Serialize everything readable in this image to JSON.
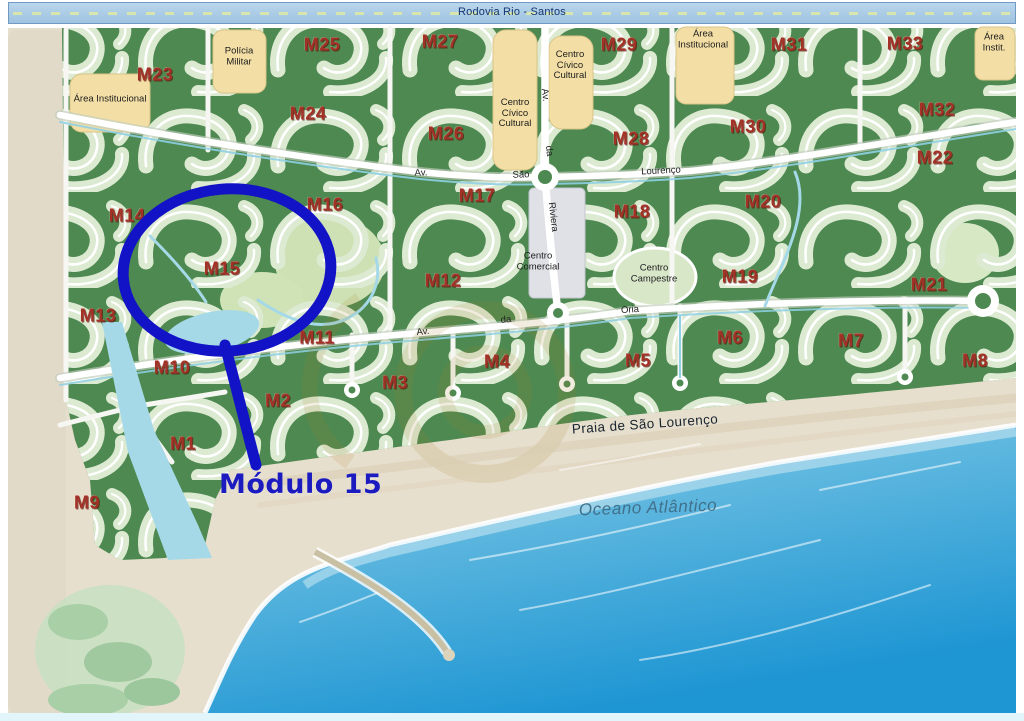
{
  "highway": {
    "label": "Rodovia Rio - Santos"
  },
  "modules": [
    {
      "id": "M1",
      "x": 183,
      "y": 444
    },
    {
      "id": "M2",
      "x": 278,
      "y": 401
    },
    {
      "id": "M3",
      "x": 395,
      "y": 383
    },
    {
      "id": "M4",
      "x": 497,
      "y": 362
    },
    {
      "id": "M5",
      "x": 638,
      "y": 361
    },
    {
      "id": "M6",
      "x": 730,
      "y": 338
    },
    {
      "id": "M7",
      "x": 851,
      "y": 341
    },
    {
      "id": "M8",
      "x": 975,
      "y": 361
    },
    {
      "id": "M9",
      "x": 87,
      "y": 503
    },
    {
      "id": "M10",
      "x": 172,
      "y": 368
    },
    {
      "id": "M11",
      "x": 317,
      "y": 338
    },
    {
      "id": "M12",
      "x": 443,
      "y": 281
    },
    {
      "id": "M13",
      "x": 98,
      "y": 316
    },
    {
      "id": "M14",
      "x": 127,
      "y": 216
    },
    {
      "id": "M15",
      "x": 222,
      "y": 269
    },
    {
      "id": "M16",
      "x": 325,
      "y": 205
    },
    {
      "id": "M17",
      "x": 477,
      "y": 196
    },
    {
      "id": "M18",
      "x": 632,
      "y": 212
    },
    {
      "id": "M19",
      "x": 740,
      "y": 277
    },
    {
      "id": "M20",
      "x": 763,
      "y": 202
    },
    {
      "id": "M21",
      "x": 929,
      "y": 285
    },
    {
      "id": "M22",
      "x": 935,
      "y": 158
    },
    {
      "id": "M23",
      "x": 155,
      "y": 75
    },
    {
      "id": "M24",
      "x": 308,
      "y": 114
    },
    {
      "id": "M25",
      "x": 322,
      "y": 45
    },
    {
      "id": "M26",
      "x": 446,
      "y": 134
    },
    {
      "id": "M27",
      "x": 440,
      "y": 42
    },
    {
      "id": "M28",
      "x": 631,
      "y": 139
    },
    {
      "id": "M29",
      "x": 619,
      "y": 45
    },
    {
      "id": "M30",
      "x": 748,
      "y": 127
    },
    {
      "id": "M31",
      "x": 789,
      "y": 45
    },
    {
      "id": "M32",
      "x": 937,
      "y": 110
    },
    {
      "id": "M33",
      "x": 905,
      "y": 44
    }
  ],
  "areas": [
    {
      "label": "Área Institucional",
      "x": 110,
      "y": 100
    },
    {
      "label": "Polícia\nMilitar",
      "x": 239,
      "y": 57
    },
    {
      "label": "Centro\nCívico\nCultural",
      "x": 515,
      "y": 114
    },
    {
      "label": "Centro\nCívico\nCultural",
      "x": 570,
      "y": 66
    },
    {
      "label": "Área\nInstitucional",
      "x": 703,
      "y": 40
    },
    {
      "label": "Área\nInstit.",
      "x": 994,
      "y": 43
    },
    {
      "label": "Centro\nComercial",
      "x": 538,
      "y": 262
    },
    {
      "label": "Centro\nCampestre",
      "x": 654,
      "y": 274
    }
  ],
  "street_labels": [
    {
      "label": "Av.",
      "x": 421,
      "y": 173,
      "angle": -2
    },
    {
      "label": "São",
      "x": 521,
      "y": 175,
      "angle": -2
    },
    {
      "label": "Lourenço",
      "x": 661,
      "y": 171,
      "angle": -3
    },
    {
      "label": "Av.",
      "x": 545,
      "y": 95,
      "angle": 83
    },
    {
      "label": "da",
      "x": 549,
      "y": 151,
      "angle": 83
    },
    {
      "label": "Riviera",
      "x": 553,
      "y": 217,
      "angle": 83
    },
    {
      "label": "Av.",
      "x": 423,
      "y": 332,
      "angle": -7
    },
    {
      "label": "da",
      "x": 506,
      "y": 320,
      "angle": -6
    },
    {
      "label": "Oria",
      "x": 630,
      "y": 310,
      "angle": -4
    }
  ],
  "beach": {
    "label": "Praia de São Lourenço"
  },
  "ocean": {
    "label": "Oceano Atlântico"
  },
  "callout": {
    "label": "Módulo 15",
    "target_module": "M15"
  },
  "colors": {
    "land_green": "#4d8950",
    "residential_green": "#dcead2",
    "sand": "#e7dfcd",
    "ocean_deep": "#1e96d3",
    "ocean_shore": "#b9e4ee",
    "water_creek": "#a5d9e8",
    "institutional_tan": "#f3dfa6",
    "commercial_gray": "#e0e1e7",
    "module_label_red": "#a33126",
    "annotation_blue": "#1212c6",
    "highway_band_blue": "#aacbe5"
  }
}
